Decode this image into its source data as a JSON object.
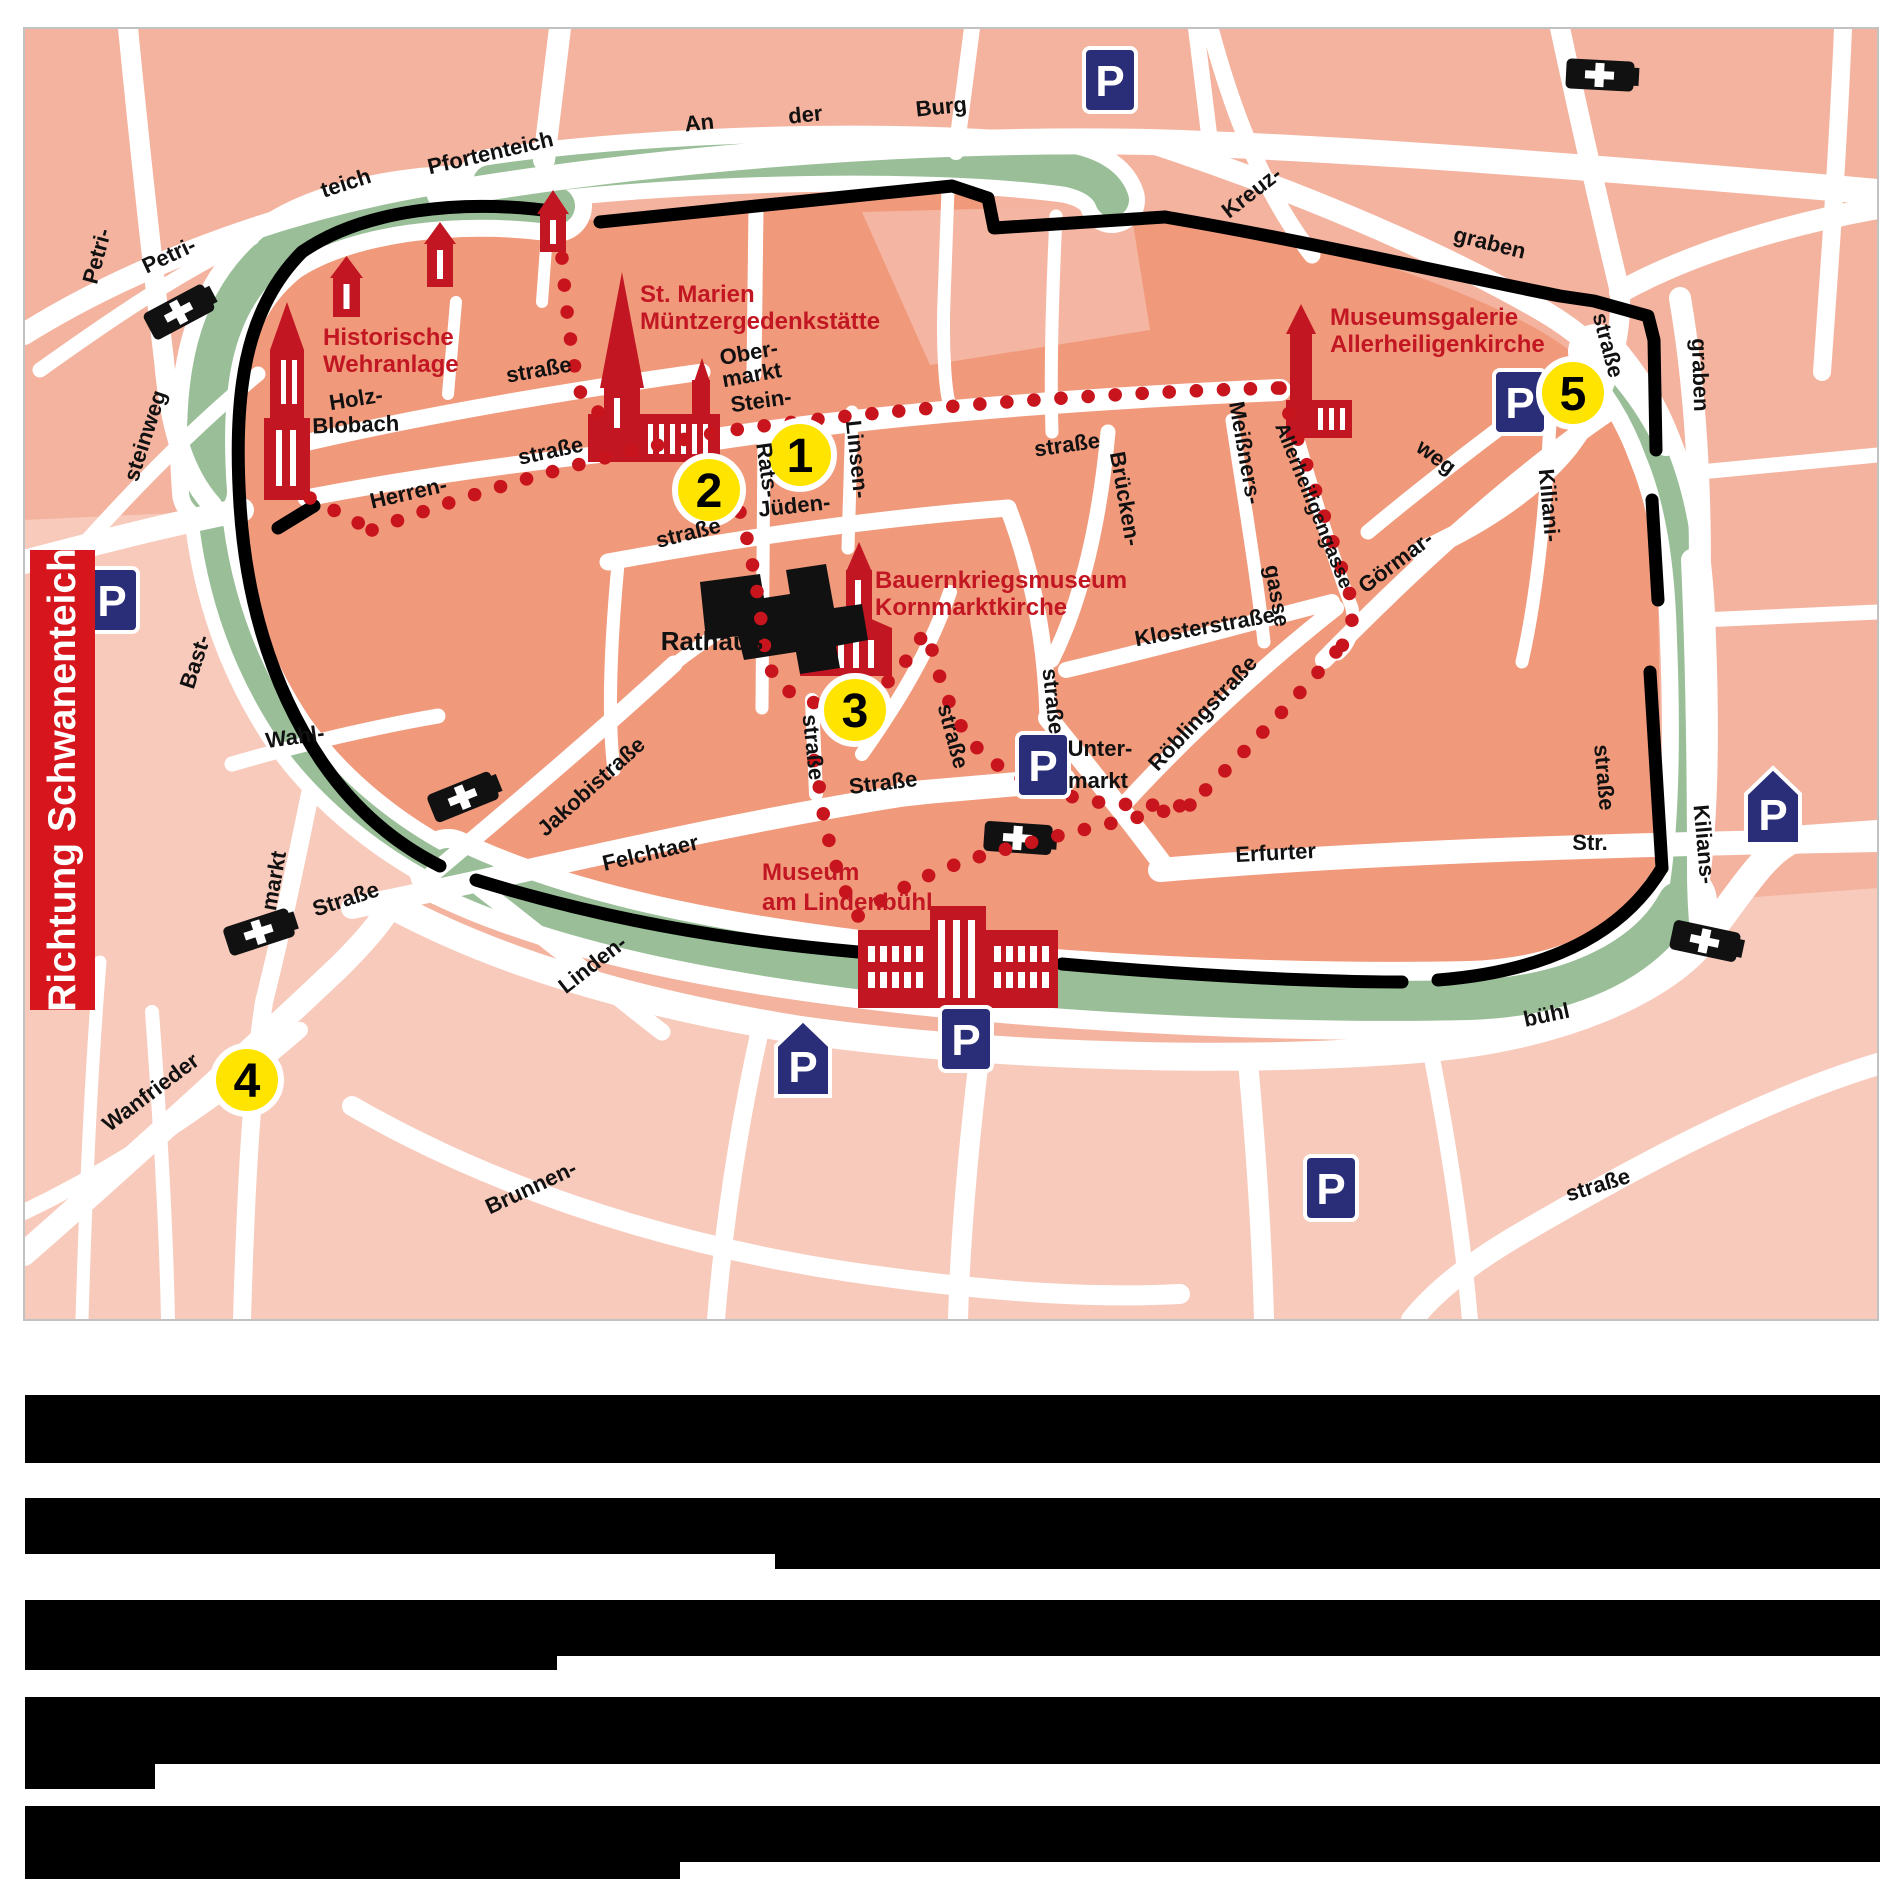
{
  "map": {
    "colors": {
      "outer_pink": "#f4b39e",
      "outer_pink_light": "#f8cabb",
      "inner_salmon": "#f0997b",
      "inner_light_block": "#f4b6a2",
      "green_belt": "#9abf98",
      "street_white": "#ffffff",
      "wall_black": "#000000",
      "route_red": "#c8151d",
      "landmark_red": "#c21723",
      "parking_blue": "#2a2d78",
      "station_yellow": "#ffe400",
      "label_black": "#111111",
      "border_gray": "#c2c2c2"
    },
    "banner": {
      "text": "Richtung Schwanenteich",
      "bg": "#d6161c",
      "fg": "#ffffff"
    },
    "stations": [
      {
        "n": "1",
        "x": 800,
        "y": 455
      },
      {
        "n": "2",
        "x": 709,
        "y": 490
      },
      {
        "n": "3",
        "x": 855,
        "y": 710
      },
      {
        "n": "4",
        "x": 247,
        "y": 1080
      },
      {
        "n": "5",
        "x": 1573,
        "y": 393
      }
    ],
    "parking": [
      {
        "x": 1110,
        "y": 80,
        "shape": "square"
      },
      {
        "x": 112,
        "y": 600,
        "shape": "square"
      },
      {
        "x": 1043,
        "y": 765,
        "shape": "square"
      },
      {
        "x": 1520,
        "y": 402,
        "shape": "square"
      },
      {
        "x": 966,
        "y": 1039,
        "shape": "square"
      },
      {
        "x": 1331,
        "y": 1188,
        "shape": "square"
      },
      {
        "x": 1773,
        "y": 806,
        "shape": "pentagon"
      },
      {
        "x": 803,
        "y": 1058,
        "shape": "pentagon"
      }
    ],
    "churches": [
      {
        "x": 179,
        "y": 312,
        "r": -28
      },
      {
        "x": 1600,
        "y": 75,
        "r": 3
      },
      {
        "x": 463,
        "y": 797,
        "r": -22
      },
      {
        "x": 1018,
        "y": 838,
        "r": 4
      },
      {
        "x": 259,
        "y": 932,
        "r": -18
      },
      {
        "x": 1705,
        "y": 941,
        "r": 12
      }
    ],
    "street_labels": [
      {
        "t": "teich",
        "x": 348,
        "y": 190,
        "r": -18
      },
      {
        "t": "Pfortenteich",
        "x": 492,
        "y": 160,
        "r": -13
      },
      {
        "t": "Petri-",
        "x": 104,
        "y": 258,
        "r": -75
      },
      {
        "t": "Petri-",
        "x": 172,
        "y": 262,
        "r": -25
      },
      {
        "t": "steinweg",
        "x": 152,
        "y": 438,
        "r": -72
      },
      {
        "t": "An",
        "x": 700,
        "y": 130,
        "r": -6
      },
      {
        "t": "der",
        "x": 806,
        "y": 122,
        "r": -6
      },
      {
        "t": "Burg",
        "x": 942,
        "y": 114,
        "r": -6
      },
      {
        "t": "Kreuz-",
        "x": 1256,
        "y": 198,
        "r": -38
      },
      {
        "t": "graben",
        "x": 1488,
        "y": 250,
        "r": 14
      },
      {
        "t": "graben",
        "x": 1693,
        "y": 375,
        "r": 88
      },
      {
        "t": "straße",
        "x": 1601,
        "y": 347,
        "r": 75
      },
      {
        "t": "Blobach",
        "x": 356,
        "y": 432,
        "r": -2
      },
      {
        "t": "Holz-",
        "x": 357,
        "y": 406,
        "r": -9
      },
      {
        "t": "straße",
        "x": 540,
        "y": 377,
        "r": -10
      },
      {
        "t": "Herren-",
        "x": 410,
        "y": 500,
        "r": -13
      },
      {
        "t": "straße",
        "x": 552,
        "y": 458,
        "r": -12
      },
      {
        "t": "Bast-",
        "x": 202,
        "y": 664,
        "r": -72
      },
      {
        "t": "Wahl-",
        "x": 296,
        "y": 744,
        "r": -8
      },
      {
        "t": "Jakobistraße",
        "x": 596,
        "y": 792,
        "r": -42
      },
      {
        "t": "Felchtaer",
        "x": 652,
        "y": 860,
        "r": -13
      },
      {
        "t": "Straße",
        "x": 884,
        "y": 790,
        "r": -7
      },
      {
        "t": "Linden-",
        "x": 597,
        "y": 970,
        "r": -38
      },
      {
        "t": "markt",
        "x": 281,
        "y": 882,
        "r": -80
      },
      {
        "t": "Straße",
        "x": 348,
        "y": 906,
        "r": -18
      },
      {
        "t": "Wanfrieder",
        "x": 155,
        "y": 1098,
        "r": -37
      },
      {
        "t": "Brunnen-",
        "x": 534,
        "y": 1194,
        "r": -25
      },
      {
        "t": "Ober-",
        "x": 750,
        "y": 360,
        "r": -10
      },
      {
        "t": "markt",
        "x": 753,
        "y": 382,
        "r": -10
      },
      {
        "t": "Stein-",
        "x": 762,
        "y": 408,
        "r": -8
      },
      {
        "t": "straße",
        "x": 1068,
        "y": 452,
        "r": -8
      },
      {
        "t": "Rats-",
        "x": 760,
        "y": 471,
        "r": 82
      },
      {
        "t": "Jüden-",
        "x": 795,
        "y": 513,
        "r": -6
      },
      {
        "t": "straße",
        "x": 690,
        "y": 540,
        "r": -14
      },
      {
        "t": "Linsen-",
        "x": 850,
        "y": 460,
        "r": 84
      },
      {
        "t": "Brücken-",
        "x": 1118,
        "y": 500,
        "r": 80
      },
      {
        "t": "straße",
        "x": 1046,
        "y": 702,
        "r": 84
      },
      {
        "t": "Meißners-",
        "x": 1238,
        "y": 454,
        "r": 80
      },
      {
        "t": "gasse",
        "x": 1270,
        "y": 597,
        "r": 80
      },
      {
        "t": "Allerheiligengasse",
        "x": 1308,
        "y": 508,
        "r": 68,
        "s": 20
      },
      {
        "t": "weg",
        "x": 1432,
        "y": 463,
        "r": 36
      },
      {
        "t": "Görmar-",
        "x": 1400,
        "y": 568,
        "r": -37
      },
      {
        "t": "Kiliani-",
        "x": 1542,
        "y": 506,
        "r": 85
      },
      {
        "t": "Klosterstraße",
        "x": 1206,
        "y": 634,
        "r": -10
      },
      {
        "t": "Röblingstraße",
        "x": 1208,
        "y": 718,
        "r": -47
      },
      {
        "t": "straße",
        "x": 946,
        "y": 738,
        "r": 75
      },
      {
        "t": "straße",
        "x": 806,
        "y": 748,
        "r": 84
      },
      {
        "t": "Unter-",
        "x": 1100,
        "y": 756,
        "r": 0
      },
      {
        "t": "markt",
        "x": 1098,
        "y": 788,
        "r": 0
      },
      {
        "t": "Erfurter",
        "x": 1276,
        "y": 860,
        "r": -3
      },
      {
        "t": "Str.",
        "x": 1590,
        "y": 850,
        "r": 0
      },
      {
        "t": "straße",
        "x": 1597,
        "y": 778,
        "r": 85
      },
      {
        "t": "Kilians-",
        "x": 1697,
        "y": 845,
        "r": 85
      },
      {
        "t": "bühl",
        "x": 1548,
        "y": 1022,
        "r": -12
      },
      {
        "t": "straße",
        "x": 1600,
        "y": 1192,
        "r": -17
      },
      {
        "t": "Rathaus",
        "x": 712,
        "y": 650,
        "r": 0,
        "s": 26
      }
    ],
    "landmark_labels": [
      {
        "name": "historische-wehranlage",
        "lines": [
          "Historische",
          "Wehranlage"
        ],
        "x": 323,
        "y": 345,
        "lh": 27
      },
      {
        "name": "st-marien",
        "lines": [
          "St. Marien",
          "Müntzergedenkstätte"
        ],
        "x": 640,
        "y": 302,
        "lh": 27
      },
      {
        "name": "museumsgalerie",
        "lines": [
          "Museumsgalerie",
          "Allerheiligenkirche"
        ],
        "x": 1330,
        "y": 325,
        "lh": 27
      },
      {
        "name": "bauernkriegsmuseum",
        "lines": [
          "Bauernkriegsmuseum",
          "Kornmarktkirche"
        ],
        "x": 875,
        "y": 588,
        "lh": 27
      },
      {
        "name": "museum-am-lindenbuehl",
        "lines": [
          "Museum",
          "am Lindenbühl"
        ],
        "x": 762,
        "y": 880,
        "lh": 30
      }
    ],
    "caption": {
      "redacted": true,
      "bars": [
        {
          "x": 25,
          "y": 1395,
          "w": 1855,
          "h": 68
        },
        {
          "x": 25,
          "y": 1498,
          "w": 1855,
          "h": 56
        },
        {
          "x": 775,
          "y": 1554,
          "w": 1105,
          "h": 15
        },
        {
          "x": 25,
          "y": 1600,
          "w": 1855,
          "h": 56
        },
        {
          "x": 25,
          "y": 1656,
          "w": 532,
          "h": 14
        },
        {
          "x": 25,
          "y": 1697,
          "w": 1855,
          "h": 67
        },
        {
          "x": 25,
          "y": 1764,
          "w": 130,
          "h": 25
        },
        {
          "x": 25,
          "y": 1806,
          "w": 1855,
          "h": 56
        },
        {
          "x": 25,
          "y": 1862,
          "w": 655,
          "h": 17
        }
      ]
    }
  }
}
